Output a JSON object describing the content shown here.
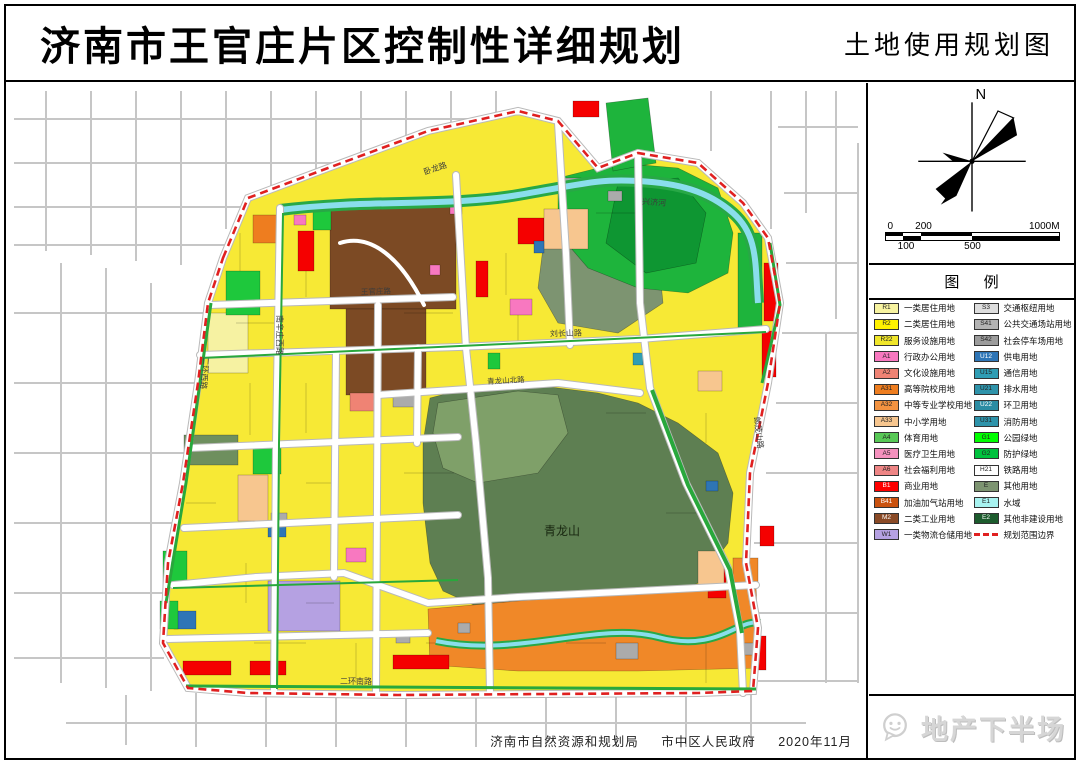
{
  "header": {
    "title": "济南市王官庄片区控制性详细规划",
    "subtitle": "土地使用规划图"
  },
  "compass": {
    "north_label": "N"
  },
  "scale_bar": {
    "zero": "0",
    "two_hundred": "200",
    "thousand": "1000M",
    "hundred": "100",
    "five_hundred": "500"
  },
  "legend": {
    "header": "图 例",
    "left": [
      {
        "code": "R1",
        "label": "一类居住用地",
        "color": "#F7F3A0"
      },
      {
        "code": "R2",
        "label": "二类居住用地",
        "color": "#FFF100"
      },
      {
        "code": "R22",
        "label": "服务设施用地",
        "color": "#F0E62A"
      },
      {
        "code": "A1",
        "label": "行政办公用地",
        "color": "#F878C0"
      },
      {
        "code": "A2",
        "label": "文化设施用地",
        "color": "#EF8374"
      },
      {
        "code": "A31",
        "label": "高等院校用地",
        "color": "#EE7D1F"
      },
      {
        "code": "A32",
        "label": "中等专业学校用地",
        "color": "#F29240"
      },
      {
        "code": "A33",
        "label": "中小学用地",
        "color": "#F7C68F"
      },
      {
        "code": "A4",
        "label": "体育用地",
        "color": "#58C856"
      },
      {
        "code": "A5",
        "label": "医疗卫生用地",
        "color": "#F591BE"
      },
      {
        "code": "A6",
        "label": "社会福利用地",
        "color": "#EE8585"
      },
      {
        "code": "B1",
        "label": "商业用地",
        "color": "#FE0000"
      },
      {
        "code": "B41",
        "label": "加油加气站用地",
        "color": "#C9510E"
      },
      {
        "code": "M2",
        "label": "二类工业用地",
        "color": "#8A4A26"
      },
      {
        "code": "W1",
        "label": "一类物流仓储用地",
        "color": "#B5A1E2"
      }
    ],
    "right": [
      {
        "code": "S3",
        "label": "交通枢纽用地",
        "color": "#DDDDDD"
      },
      {
        "code": "S41",
        "label": "公共交通场站用地",
        "color": "#B3B3B3"
      },
      {
        "code": "S42",
        "label": "社会停车场用地",
        "color": "#9C9C9C"
      },
      {
        "code": "U12",
        "label": "供电用地",
        "color": "#2E75B6"
      },
      {
        "code": "U15",
        "label": "通信用地",
        "color": "#2F9DB4"
      },
      {
        "code": "U21",
        "label": "排水用地",
        "color": "#2E93AA"
      },
      {
        "code": "U22",
        "label": "环卫用地",
        "color": "#2B8CA3"
      },
      {
        "code": "U31",
        "label": "消防用地",
        "color": "#2E93AA"
      },
      {
        "code": "G1",
        "label": "公园绿地",
        "color": "#00FE00"
      },
      {
        "code": "G2",
        "label": "防护绿地",
        "color": "#00C23E"
      },
      {
        "code": "H21",
        "label": "铁路用地",
        "color": "#FFFFFF"
      },
      {
        "code": "E",
        "label": "其他用地",
        "color": "#7D9471"
      },
      {
        "code": "E1",
        "label": "水域",
        "color": "#A8F3F0"
      },
      {
        "code": "E2",
        "label": "其他非建设用地",
        "color": "#1C5B2D"
      },
      {
        "code": "",
        "label": "规划范围边界",
        "color": "#E02020",
        "symbol": "dashed"
      }
    ]
  },
  "map": {
    "labels": [
      {
        "text": "卧龙路",
        "x": 430,
        "y": 88,
        "rot": -18,
        "size": 8
      },
      {
        "text": "兴济河",
        "x": 648,
        "y": 122,
        "rot": 4,
        "size": 8
      },
      {
        "text": "南辛庄西路",
        "x": 271,
        "y": 252,
        "rot": 90,
        "size": 8
      },
      {
        "text": "二环西路",
        "x": 196,
        "y": 290,
        "rot": 95,
        "size": 8
      },
      {
        "text": "王官庄路",
        "x": 370,
        "y": 211,
        "rot": -2,
        "size": 7.5
      },
      {
        "text": "刘长山路",
        "x": 560,
        "y": 253,
        "rot": -2,
        "size": 8
      },
      {
        "text": "青龙山北路",
        "x": 500,
        "y": 300,
        "rot": -3,
        "size": 7.5
      },
      {
        "text": "郎茂山路",
        "x": 750,
        "y": 350,
        "rot": 83,
        "size": 8
      },
      {
        "text": "青龙山",
        "x": 556,
        "y": 452,
        "rot": 0,
        "size": 12,
        "dark": true
      },
      {
        "text": "二环南路",
        "x": 350,
        "y": 601,
        "rot": 0,
        "size": 8
      }
    ],
    "boundary_color": "#E02020"
  },
  "footer": {
    "org1": "济南市自然资源和规划局",
    "org2": "市中区人民政府",
    "date": "2020年11月"
  },
  "watermark": {
    "text": "地产下半场"
  }
}
